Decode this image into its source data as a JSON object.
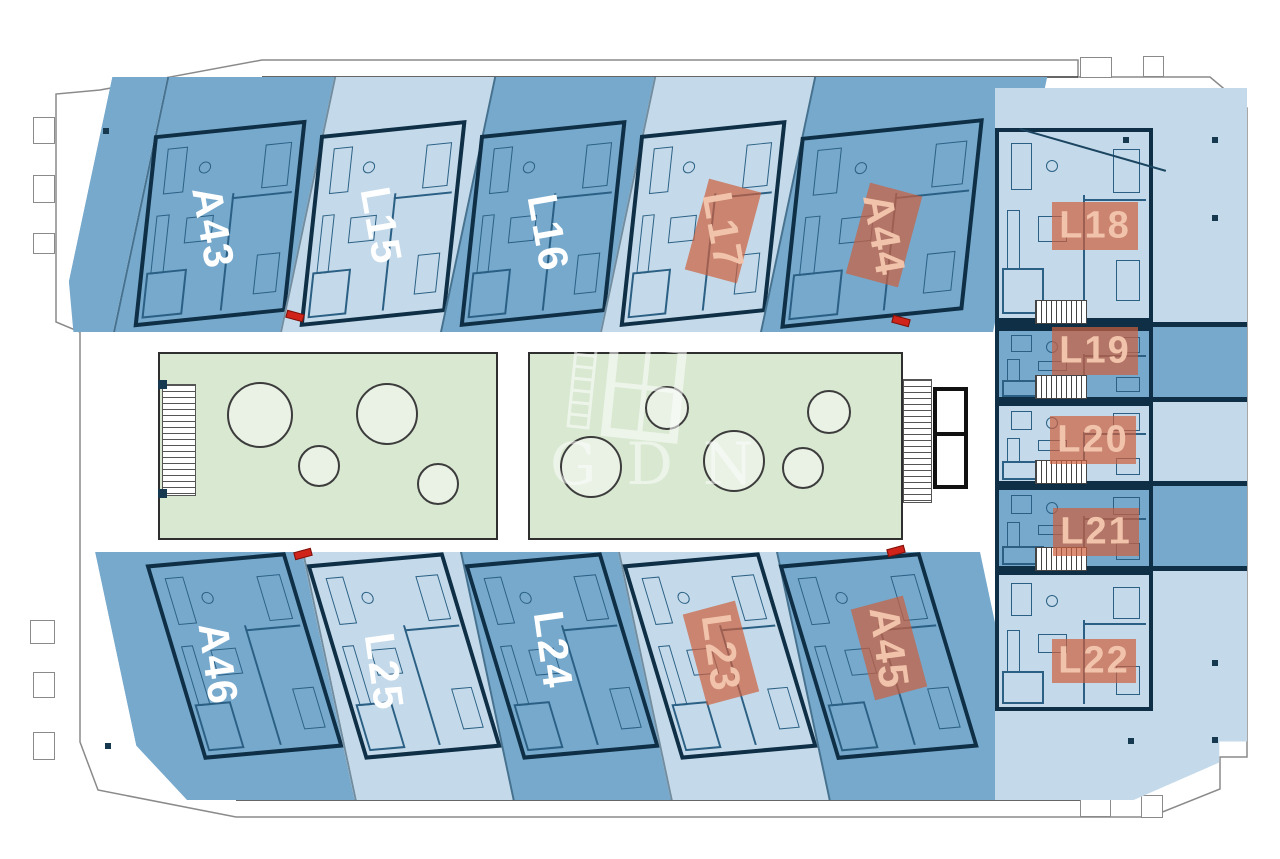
{
  "floorplan": {
    "watermark_text": "GDN",
    "units": [
      {
        "id": "A43",
        "row": "top",
        "tone": "dark",
        "highlighted": false
      },
      {
        "id": "L15",
        "row": "top",
        "tone": "light",
        "highlighted": false
      },
      {
        "id": "L16",
        "row": "top",
        "tone": "dark",
        "highlighted": false
      },
      {
        "id": "L17",
        "row": "top",
        "tone": "light",
        "highlighted": true
      },
      {
        "id": "A44",
        "row": "top",
        "tone": "dark",
        "highlighted": true
      },
      {
        "id": "L18",
        "row": "right",
        "tone": "light",
        "highlighted": true
      },
      {
        "id": "L19",
        "row": "right",
        "tone": "dark",
        "highlighted": true
      },
      {
        "id": "L20",
        "row": "right",
        "tone": "light",
        "highlighted": true
      },
      {
        "id": "L21",
        "row": "right",
        "tone": "dark",
        "highlighted": true
      },
      {
        "id": "L22",
        "row": "right",
        "tone": "light",
        "highlighted": true
      },
      {
        "id": "A45",
        "row": "bottom",
        "tone": "dark",
        "highlighted": true
      },
      {
        "id": "L23",
        "row": "bottom",
        "tone": "light",
        "highlighted": true
      },
      {
        "id": "L24",
        "row": "bottom",
        "tone": "dark",
        "highlighted": false
      },
      {
        "id": "L25",
        "row": "bottom",
        "tone": "light",
        "highlighted": false
      },
      {
        "id": "A46",
        "row": "bottom",
        "tone": "dark",
        "highlighted": false
      }
    ],
    "palette": {
      "unit_dark_blue": "#76a9cc",
      "unit_light_blue": "#c4daea",
      "highlight_salmon": "#cd5f3c",
      "courtyard_green": "#d9e8d1",
      "tree_fill": "#eaf2e6",
      "wall_color": "#0e2f45",
      "entrance_marker_red": "#d0241a"
    }
  }
}
